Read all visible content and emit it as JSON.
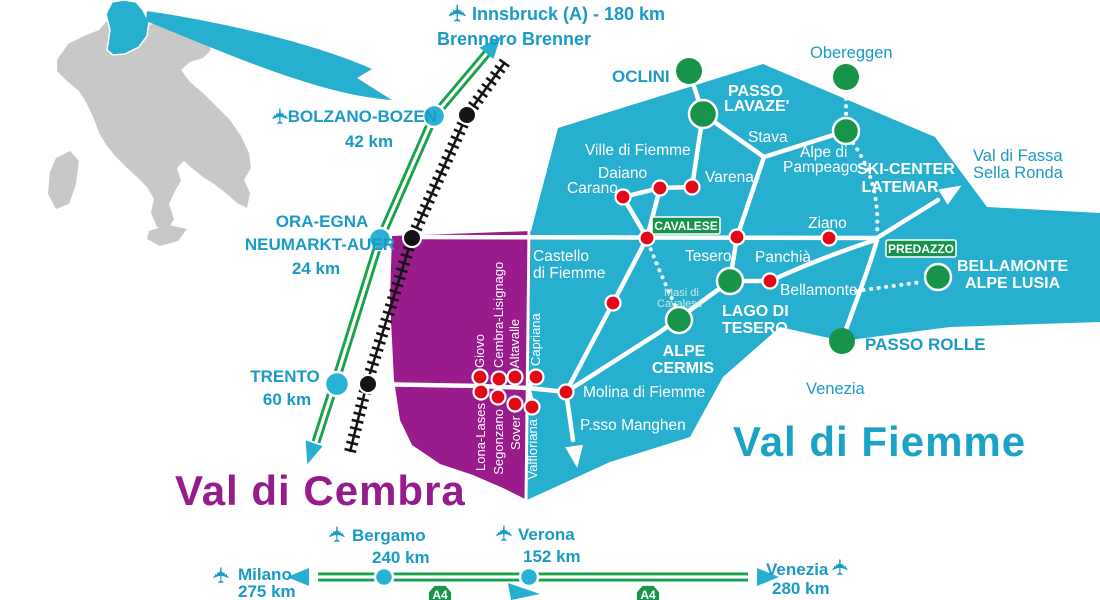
{
  "valleys": {
    "fiemme": "Val di Fiemme",
    "cembra": "Val di Cembra"
  },
  "north_access": {
    "innsbruck": "Innsbruck (A) - 180 km",
    "brennero": "Brennero Brenner",
    "bolzano": "BOLZANO-BOZEN",
    "bolzano_km": "42 km",
    "ora_line1": "ORA-EGNA",
    "ora_line2": "NEUMARKT-AUER",
    "ora_km": "24 km",
    "trento": "TRENTO",
    "trento_km": "60 km"
  },
  "south_access": {
    "milano": "Milano",
    "milano_km": "275 km",
    "bergamo": "Bergamo",
    "bergamo_km": "240 km",
    "verona": "Verona",
    "verona_km": "152 km",
    "venezia": "Venezia",
    "venezia_km": "280 km",
    "a4": "A4"
  },
  "fiemme_towns": {
    "ville": "Ville di Fiemme",
    "carano": "Carano",
    "daiano": "Daiano",
    "varena": "Varena",
    "stava": "Stava",
    "alpe_di": "Alpe di",
    "pampeago": "Pampeago",
    "castello1": "Castello",
    "castello2": "di Fiemme",
    "tesero": "Tesero",
    "panchia": "Panchià",
    "ziano": "Ziano",
    "bellamonte": "Bellamonte",
    "masi1": "Masi di",
    "masi2": "Cavalese",
    "molina": "Molina di Fiemme",
    "manghen": "P.sso Manghen",
    "venezia_dir": "Venezia"
  },
  "ski_areas": {
    "oclini": "OCLINI",
    "lavaze1": "PASSO",
    "lavaze2": "LAVAZE'",
    "obereggen": "Obereggen",
    "latemar1": "SKI-CENTER",
    "latemar2": "LATEMAR",
    "lago1": "LAGO DI",
    "lago2": "TESERO",
    "cermis1": "ALPE",
    "cermis2": "CERMIS",
    "lusia1": "BELLAMONTE",
    "lusia2": "ALPE LUSIA",
    "rolle": "PASSO ROLLE",
    "fassa1": "Val di Fassa",
    "fassa2": "Sella Ronda"
  },
  "badges": {
    "cavalese": "CAVALESE",
    "predazzo": "PREDAZZO"
  },
  "cembra_towns": {
    "giovo": "Giovo",
    "cembra_lisignago": "Cembra-Lisignago",
    "altavalle": "Altavalle",
    "capriana": "Capriana",
    "lona_lases": "Lona-Lases",
    "segonzano": "Segonzano",
    "sover": "Sover",
    "valfloriana": "Valfloriana"
  },
  "icons": {
    "plane": "✈"
  },
  "colors": {
    "teal_region": "#27afd0",
    "teal_text": "#1a9ac6",
    "purple_region": "#9a1b8c",
    "purple_text": "#951c8a",
    "road_green": "#18a24b",
    "badge_green": "#17934a",
    "town_red": "#e30a17",
    "italy_gray": "#c8c8c8",
    "rail_black": "#141414"
  }
}
